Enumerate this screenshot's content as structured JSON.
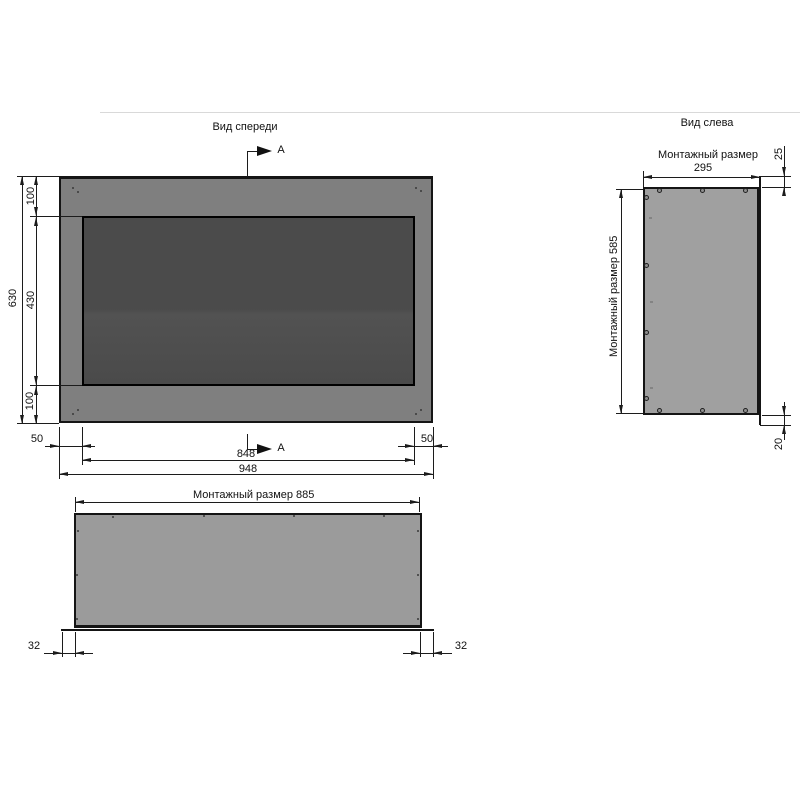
{
  "titles": {
    "front": "Вид спереди",
    "left_view": "Вид слева"
  },
  "section_labels": {
    "top": "A",
    "bottom": "A"
  },
  "front_dims": {
    "total_height": "630",
    "margin_top": "100",
    "screen_height": "430",
    "margin_bottom": "100",
    "margin_left": "50",
    "margin_right": "50",
    "screen_width": "848",
    "total_width": "948"
  },
  "bottom_view_dims": {
    "mounting_width": "Монтажный размер 885",
    "overhang_left": "32",
    "overhang_right": "32"
  },
  "left_view_dims": {
    "mounting_depth_label": "Монтажный размер",
    "mounting_depth_value": "295",
    "offset_top": "25",
    "mounting_height": "Монтажный размер 585",
    "offset_bottom": "20"
  },
  "colors": {
    "bezel": "#7f7f7f",
    "screen": "#4b4b4b",
    "side_panel": "#a0a0a0",
    "bottom_panel": "#9b9b9b",
    "line": "#151515"
  }
}
